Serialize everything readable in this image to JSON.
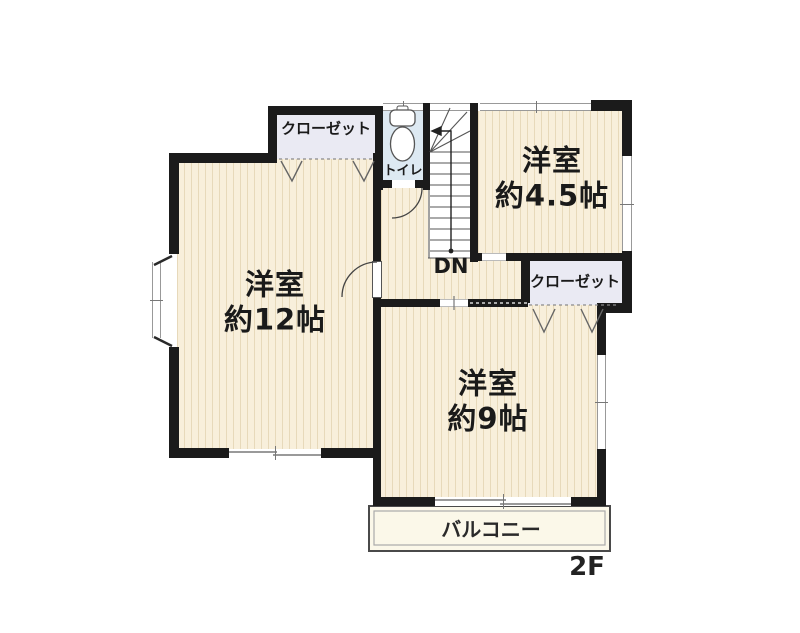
{
  "floor_plan": {
    "floor_label": "2F",
    "rooms": {
      "western_room_12": {
        "name": "洋室",
        "size": "約12帖"
      },
      "western_room_45": {
        "name": "洋室",
        "size": "約4.5帖"
      },
      "western_room_9": {
        "name": "洋室",
        "size": "約9帖"
      },
      "closet_top": {
        "label": "クローゼット"
      },
      "closet_right": {
        "label": "クローゼット"
      },
      "toilet": {
        "label": "トイレ"
      },
      "stairs": {
        "label": "DN"
      },
      "balcony": {
        "label": "バルコニー"
      }
    },
    "colors": {
      "wall": "#1b1b1b",
      "room_floor": "#f8efdb",
      "floor_stripe": "#e7d9ba",
      "toilet_floor": "#dde9f2",
      "closet_floor": "#eaeaf3",
      "balcony_floor": "#fbf8e9",
      "background": "#ffffff"
    }
  }
}
